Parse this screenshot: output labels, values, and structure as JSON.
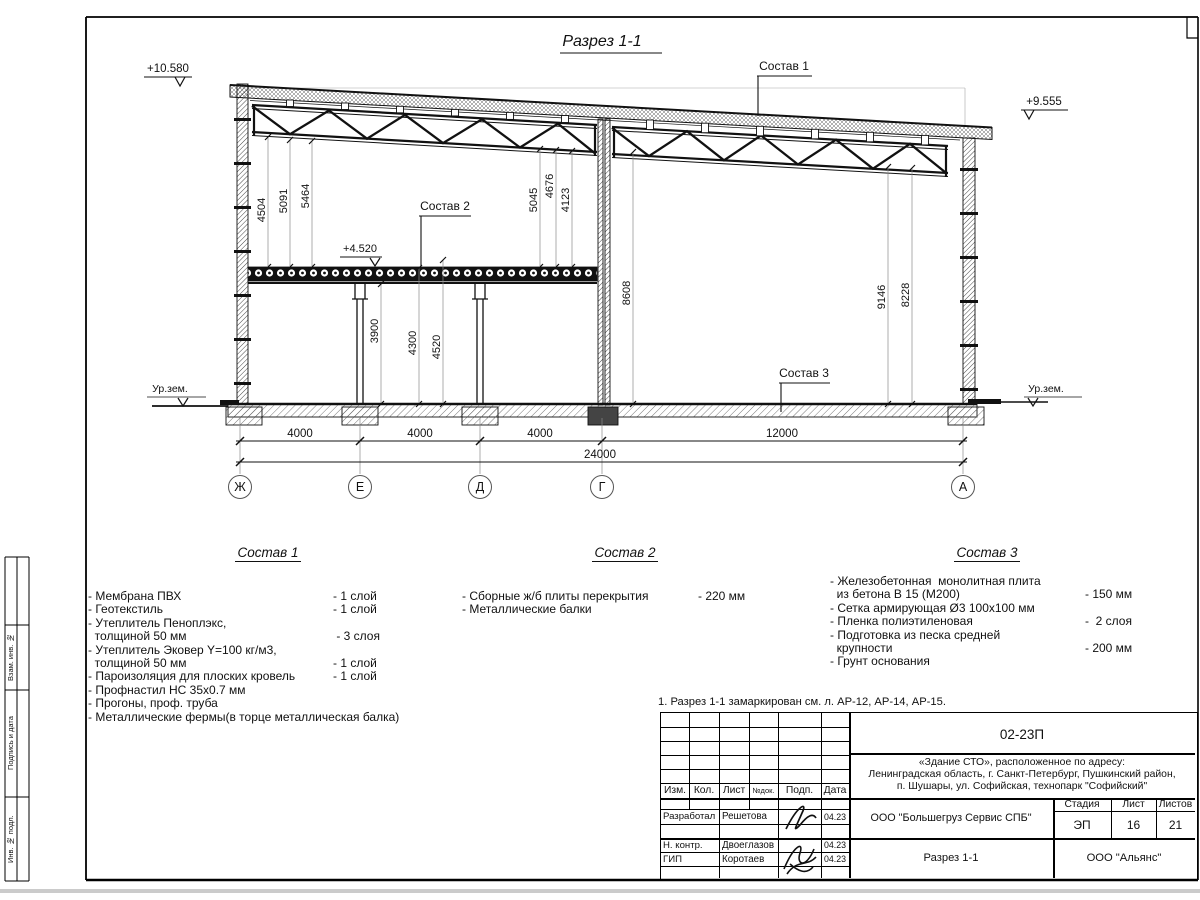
{
  "sheet": {
    "title": "Разрез 1-1",
    "note": "1. Разрез 1-1 замаркирован см. л. АР-12, АР-14, АР-15."
  },
  "marks": {
    "elev_left": "+10.580",
    "elev_right": "+9.555",
    "slab_elev": "+4.520",
    "ground_left": "Ур.зем.",
    "ground_right": "Ур.зем."
  },
  "leaders": {
    "s1": "Состав 1",
    "s2": "Состав 2",
    "s3": "Состав 3"
  },
  "dims": {
    "v1": "4504",
    "v2": "5091",
    "v3": "5464",
    "v4": "5045",
    "v5": "4676",
    "v6": "4123",
    "v7": "8608",
    "v8": "9146",
    "v9": "8228",
    "v10": "3900",
    "v11": "4300",
    "v12": "4520",
    "span1": "4000",
    "span2": "4000",
    "span3": "4000",
    "span4": "12000",
    "total": "24000"
  },
  "axes": [
    "Ж",
    "Е",
    "Д",
    "Г",
    "А"
  ],
  "compositions": [
    {
      "title": "Состав 1",
      "items": [
        {
          "t": "- Мембрана ПВХ",
          "v": "- 1 слой"
        },
        {
          "t": "- Геотекстиль",
          "v": "- 1 слой"
        },
        {
          "t": "- Утеплитель Пеноплэкс,",
          "v": ""
        },
        {
          "t": "  толщиной 50 мм",
          "v": " - 3 слоя"
        },
        {
          "t": "- Утеплитель Эковер Y=100 кг/м3,",
          "v": ""
        },
        {
          "t": "  толщиной 50 мм",
          "v": "- 1 слой"
        },
        {
          "t": "- Пароизоляция для плоских кровель",
          "v": "- 1 слой"
        },
        {
          "t": "- Профнастил НС 35х0.7 мм",
          "v": ""
        },
        {
          "t": "- Прогоны, проф. труба",
          "v": ""
        },
        {
          "t": "- Металлические фермы(в торце металлическая балка)",
          "v": ""
        }
      ]
    },
    {
      "title": "Состав 2",
      "items": [
        {
          "t": "- Сборные ж/б плиты перекрытия",
          "v": "- 220 мм"
        },
        {
          "t": "- Металлические балки",
          "v": ""
        }
      ]
    },
    {
      "title": "Состав 3",
      "items": [
        {
          "t": "- Железобетонная  монолитная плита",
          "v": ""
        },
        {
          "t": "  из бетона В 15 (М200)",
          "v": "- 150 мм"
        },
        {
          "t": "- Сетка армирующая Ø3 100х100 мм",
          "v": ""
        },
        {
          "t": "- Пленка полиэтиленовая",
          "v": "-  2 слоя"
        },
        {
          "t": "- Подготовка из песка средней",
          "v": ""
        },
        {
          "t": "  крупности",
          "v": "- 200 мм"
        },
        {
          "t": "- Грунт основания",
          "v": ""
        }
      ]
    }
  ],
  "titleblock": {
    "code": "02-23П",
    "object1": "«Здание СТО», расположенное по адресу:",
    "object2": "Ленинградская область, г. Санкт-Петербург, Пушкинский район,",
    "object3": "п. Шушары, ул. Софийская, технопарк \"Софийский\"",
    "col_izm": "Изм.",
    "col_kol": "Кол.",
    "col_list": "Лист",
    "col_ndok": "№док.",
    "col_podp": "Подп.",
    "col_data": "Дата",
    "row1_role": "Разработал",
    "row1_name": "Решетова",
    "row1_date": "04.23",
    "row2_role": "Н. контр.",
    "row2_name": "Двоеглазов",
    "row2_date": "04.23",
    "row3_role": "ГИП",
    "row3_name": "Коротаев",
    "row3_date": "04.23",
    "org": "ООО \"Большегруз Сервис СПБ\"",
    "doc_title": "Разрез 1-1",
    "stage_label": "Стадия",
    "sheet_label": "Лист",
    "sheets_label": "Листов",
    "stage": "ЭП",
    "sheet_no": "16",
    "sheets_total": "21",
    "company": "ООО \"Альянс\""
  },
  "side_labels": {
    "l1": "Взам. инв. №",
    "l2": "Подпись и дата",
    "l3": "Инв. № подл."
  }
}
